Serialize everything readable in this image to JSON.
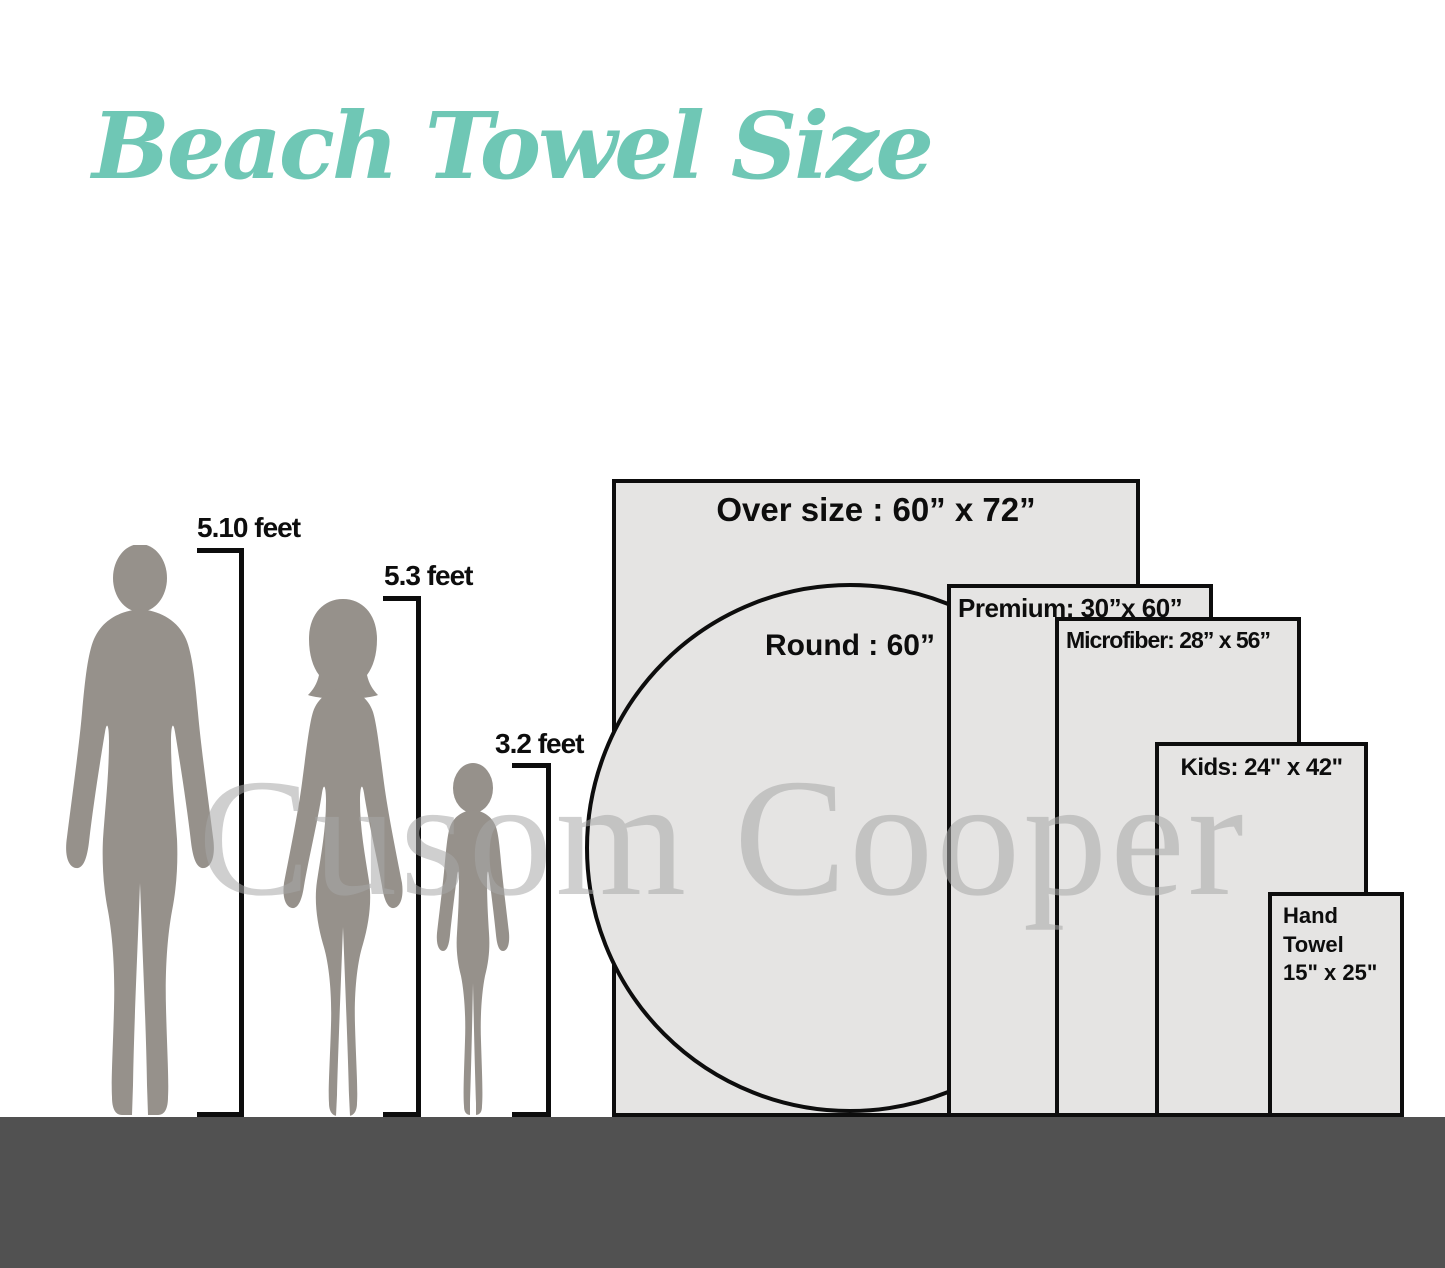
{
  "title": "Beach Towel Size",
  "watermark": "Cusom Cooper",
  "people": [
    {
      "id": "man",
      "height_label": "5.10 feet"
    },
    {
      "id": "woman",
      "height_label": "5.3 feet"
    },
    {
      "id": "child",
      "height_label": "3.2 feet"
    }
  ],
  "towels": [
    {
      "id": "oversize",
      "label": "Over size : 60” x 72”",
      "width_in": 60,
      "length_in": 72
    },
    {
      "id": "round",
      "label": "Round : 60”",
      "diameter_in": 60
    },
    {
      "id": "premium",
      "label": "Premium: 30”x 60”",
      "width_in": 30,
      "length_in": 60
    },
    {
      "id": "microfiber",
      "label": "Microfiber: 28” x 56”",
      "width_in": 28,
      "length_in": 56
    },
    {
      "id": "kids",
      "label": "Kids: 24\" x 42\"",
      "width_in": 24,
      "length_in": 42
    },
    {
      "id": "hand",
      "label_line1": "Hand Towel",
      "label_line2": "15\" x 25\"",
      "width_in": 15,
      "length_in": 25
    }
  ],
  "colors": {
    "accent_teal": "#6fc7b5",
    "silhouette_gray": "#96918b",
    "towel_fill": "#e5e4e3",
    "outline_black": "#0d0d0d",
    "ground_gray": "#515151",
    "watermark_gray": "#a8a8a8"
  }
}
